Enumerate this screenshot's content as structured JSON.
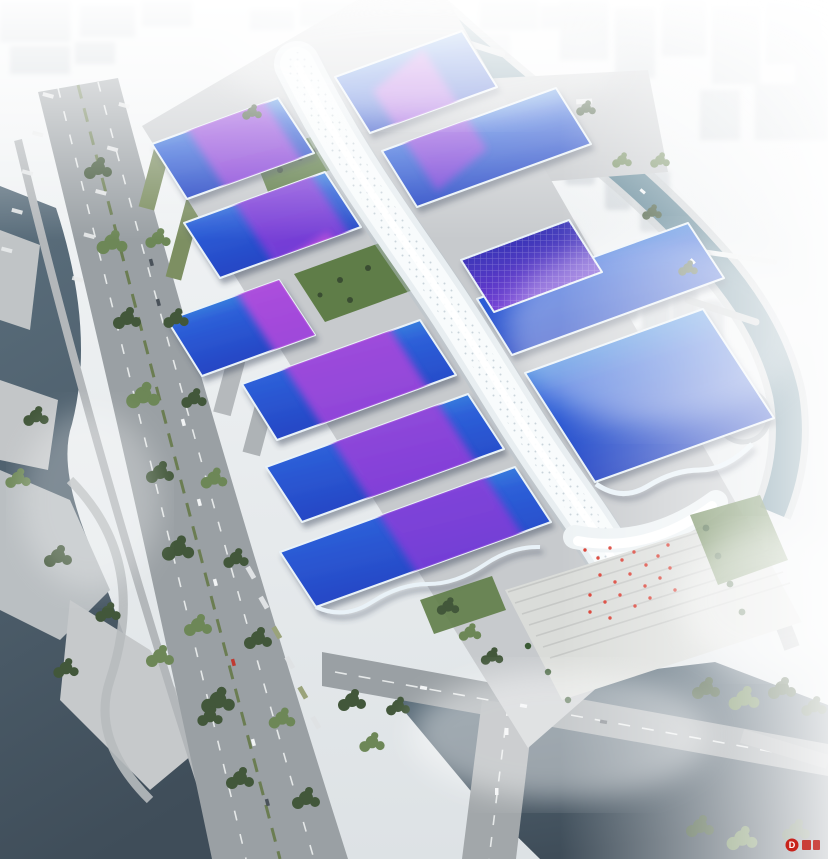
{
  "scene": {
    "watermark": {
      "logo_letter": "D",
      "color": "#c8221b"
    },
    "complex": {
      "hall_rows_left": 6,
      "hall_rows_right": 5,
      "courtyard_gardens": 2,
      "central_spine_segments": 1
    }
  },
  "colors": {
    "sky_top": "#f5f7f8",
    "sky_bottom": "#dde2e5",
    "fog": "#ffffff",
    "city": "#ccd2d7",
    "water_dark": "#3f4d59",
    "water_mid": "#5b6f7d",
    "water_teal": "#577f90",
    "road": "#9aa0a4",
    "road_light": "#b4b8bb",
    "apron": "#c7cacd",
    "plaza": "#dadcd9",
    "lawn": "#5f7d48",
    "tree_dark": "#42573a",
    "tree_light": "#6d8757",
    "roof_cyan": "#4fc0e8",
    "roof_blue": "#2d5fd8",
    "roof_deep": "#2340c0",
    "roof_deep2": "#1c33a8",
    "ribbon_magenta": "#c44fdd",
    "ribbon_violet": "#7a3cd8",
    "spine": "#e8eef1",
    "spine_highlight": "#ffffff",
    "canopy": "#eef3f5",
    "red_accent": "#d8372b",
    "warehouse_green": "#7d8f62",
    "facade_shadow": "#39455a"
  }
}
